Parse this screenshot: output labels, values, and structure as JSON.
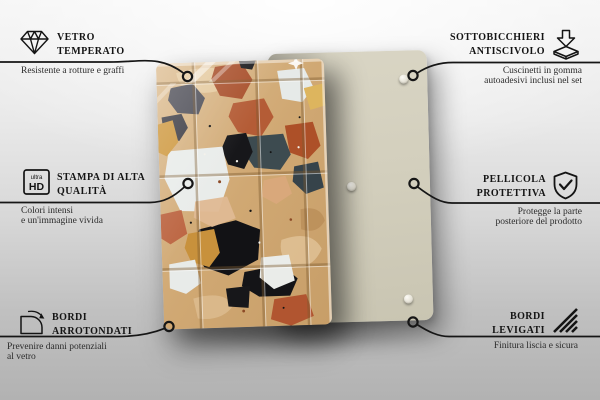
{
  "scene": {
    "description": "Product feature infographic: terrazzo-pattern tempered glass coasters, front and back view with six feature callouts"
  },
  "callouts": {
    "left": [
      {
        "icon": "diamond",
        "title_lines": [
          "VETRO",
          "TEMPERATO"
        ],
        "desc_lines": [
          "Resistente a rotture e graffi"
        ]
      },
      {
        "icon": "ultra-hd",
        "title_lines": [
          "STAMPA DI ALTA",
          "QUALITÀ"
        ],
        "desc_lines": [
          "Colori intensi",
          "e un'immagine vivida"
        ]
      },
      {
        "icon": "rounded-corner",
        "title_lines": [
          "BORDI",
          "ARROTONDATI"
        ],
        "desc_lines": [
          "Prevenire danni potenziali",
          "al vetro"
        ]
      }
    ],
    "right": [
      {
        "icon": "anti-slip-pad",
        "title_lines": [
          "SOTTOBICCHIERI",
          "ANTISCIVOLO"
        ],
        "desc_lines": [
          "Cuscinetti in gomma",
          "autoadesivi inclusi nel set"
        ]
      },
      {
        "icon": "shield-check",
        "title_lines": [
          "PELLICOLA",
          "PROTETTIVA"
        ],
        "desc_lines": [
          "Protegge la parte",
          "posteriore del prodotto"
        ]
      },
      {
        "icon": "polished-edge",
        "title_lines": [
          "BORDI",
          "LEVIGATI"
        ],
        "desc_lines": [
          "Finitura liscia e sicura"
        ]
      }
    ]
  },
  "hd_icon": {
    "small": "ultra",
    "big": "HD"
  },
  "colors": {
    "line": "#161616",
    "back_panel": "#d3cfbd",
    "terrazzo_base": "#d2ab79",
    "terracotta": "#b0572f",
    "slate": "#3d4b50",
    "black_chip": "#141417",
    "white_chip": "#e9ecea",
    "ochre": "#c8913c"
  }
}
